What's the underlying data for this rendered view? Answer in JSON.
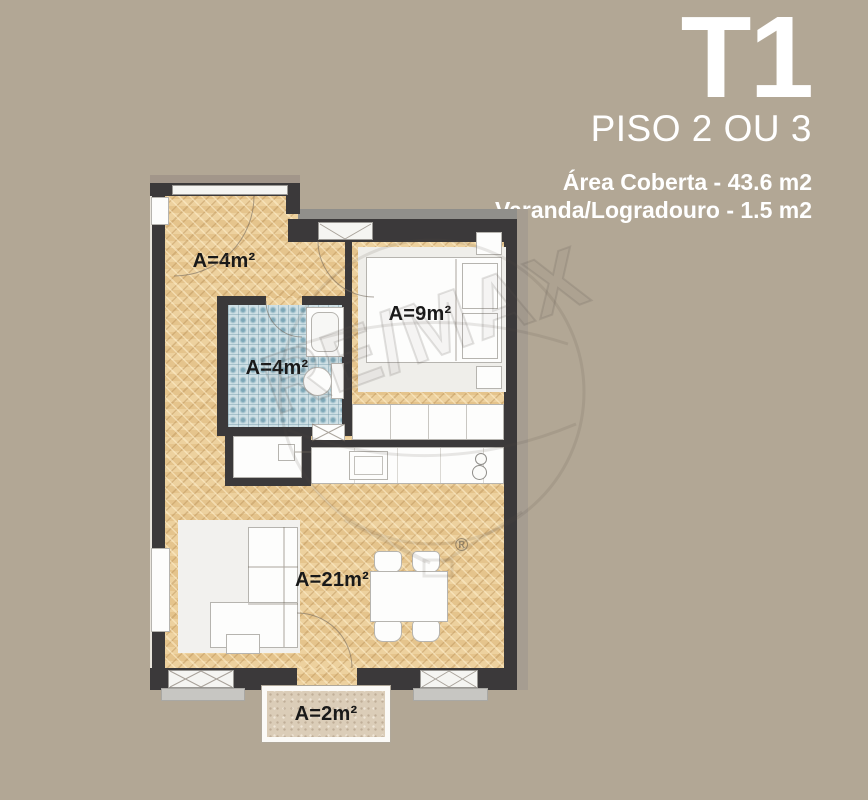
{
  "header": {
    "title": "T1",
    "subtitle": "PISO 2 OU 3",
    "area_coberta": "Área Coberta - 43.6 m2",
    "varanda": "Varanda/Logradouro - 1.5 m2"
  },
  "plan": {
    "rooms": {
      "hall": {
        "name": "entrance hall",
        "area_label": "A=4m²"
      },
      "bathroom": {
        "name": "bathroom",
        "area_label": "A=4m²"
      },
      "bedroom": {
        "name": "bedroom",
        "area_label": "A=9m²"
      },
      "living": {
        "name": "living room / kitchen",
        "area_label": "A=21m²"
      },
      "balcony": {
        "name": "balcony",
        "area_label": "A=2m²"
      }
    }
  },
  "watermark": {
    "text": "RE/MAX",
    "registered": "®"
  },
  "colors": {
    "background": "#b2a795",
    "wall": "#3b393a",
    "parquet_floor": "#e8c995",
    "bathroom_tile": "#9fc0cc",
    "balcony_floor": "#dbcdb8",
    "heading_text": "#ffffff",
    "label_text": "#191919"
  }
}
